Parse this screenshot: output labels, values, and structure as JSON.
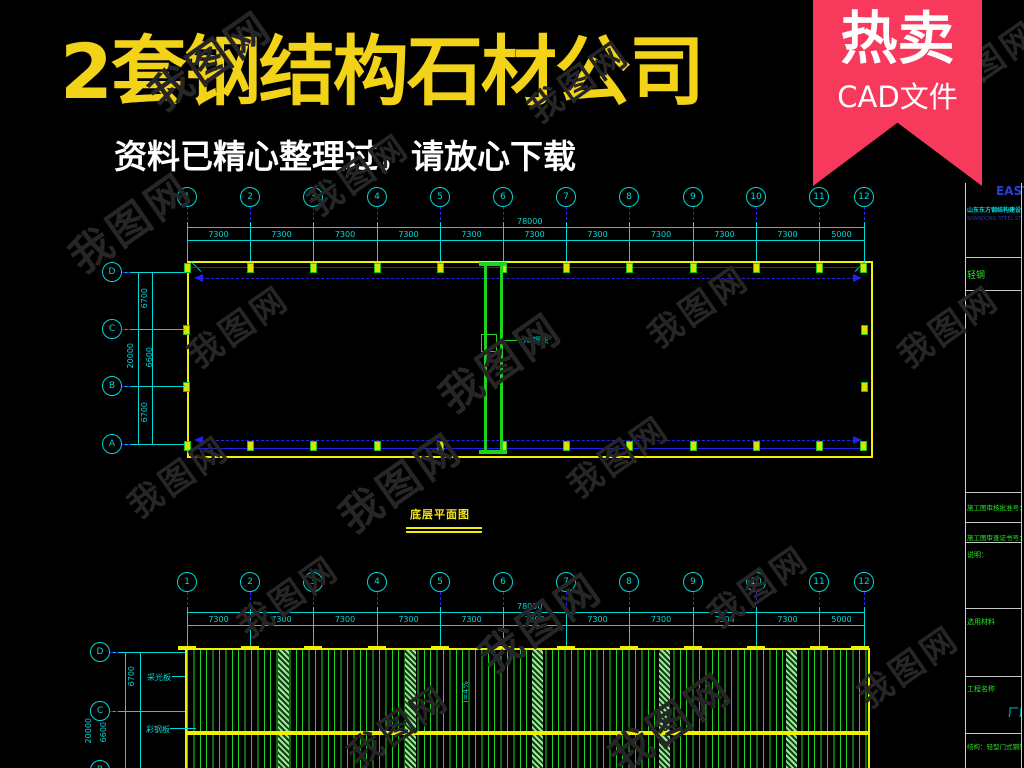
{
  "header": {
    "title": "2套钢结构石材公司",
    "subtitle": "资料已精心整理过，请放心下载",
    "ribbon": {
      "line1": "热卖",
      "line2": "CAD文件"
    }
  },
  "watermark": {
    "text": "我图网"
  },
  "colors": {
    "accent_yellow": "#f2d318",
    "ribbon_pink": "#f7395c",
    "cad_cyan": "#00d8d8",
    "cad_blue": "#2222f0",
    "cad_yellow": "#f0f000",
    "cad_green": "#1ed41e",
    "band_green": "#9ce89c"
  },
  "drawing1": {
    "caption": "底层平面图",
    "grid_numbers": [
      "1",
      "2",
      "3",
      "4",
      "5",
      "6",
      "7",
      "8",
      "9",
      "10",
      "11",
      "12"
    ],
    "row_letters": [
      "D",
      "C",
      "B",
      "A"
    ],
    "dim_top": {
      "total": "78000",
      "segments": [
        "7300",
        "7300",
        "7300",
        "7300",
        "7300",
        "7300",
        "7300",
        "7300",
        "7300",
        "7300",
        "5000"
      ]
    },
    "dim_left": {
      "total": "20000",
      "segments": [
        "6700",
        "6600",
        "6700"
      ]
    },
    "center_column_label": "5#钢架"
  },
  "drawing2": {
    "grid_numbers": [
      "1",
      "2",
      "3",
      "4",
      "5",
      "6",
      "7",
      "8",
      "9",
      "10",
      "11",
      "12"
    ],
    "row_letters": [
      "D",
      "C",
      "B"
    ],
    "dim_top": {
      "total": "78000",
      "segments": [
        "7300",
        "7300",
        "7300",
        "7300",
        "7300",
        "7300",
        "7300",
        "7300",
        "7300",
        "7300",
        "5000"
      ]
    },
    "dim_left": {
      "total": "20000",
      "segments": [
        "6700",
        "6600"
      ]
    },
    "left_labels": [
      "采光板",
      "彩钢板"
    ],
    "slope_label": "i=4%"
  },
  "titleblock": {
    "brand": "EAST",
    "company": "山东东方钢结构建设工程有限公司",
    "company_sub": "SHANDONG STEEL STRUCTURE CO.,LTD",
    "rows": [
      "轻钢",
      "施工图审核批准号：",
      "施工图审查证书号：",
      "说明：",
      "选用材料",
      "工程名称",
      "厂房",
      "结构：轻型门式钢架"
    ]
  }
}
